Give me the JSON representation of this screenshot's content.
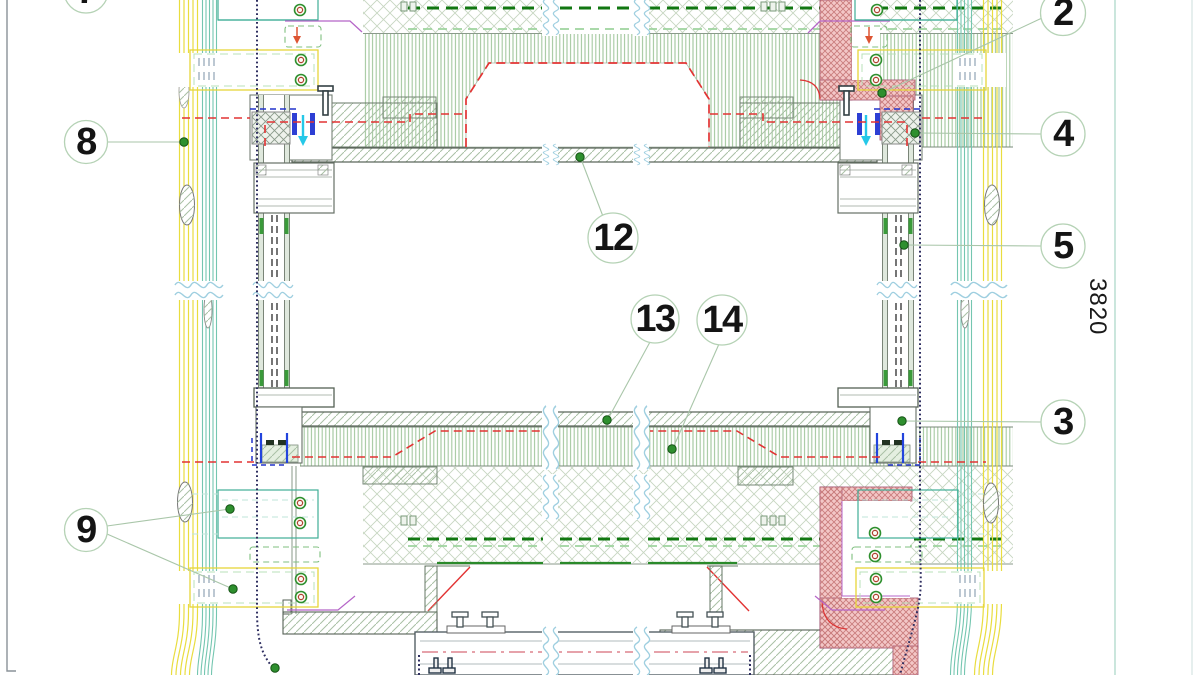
{
  "callouts": [
    {
      "id": "7",
      "label": "7"
    },
    {
      "id": "8",
      "label": "8"
    },
    {
      "id": "9",
      "label": "9"
    },
    {
      "id": "2",
      "label": "2"
    },
    {
      "id": "4",
      "label": "4"
    },
    {
      "id": "5",
      "label": "5"
    },
    {
      "id": "3",
      "label": "3"
    },
    {
      "id": "12",
      "label": "12"
    },
    {
      "id": "13",
      "label": "13"
    },
    {
      "id": "14",
      "label": "14"
    }
  ],
  "dimension": {
    "label": "3820"
  },
  "colors": {
    "band_yellow": "#e9dd3f",
    "band_teal": "#74c6b0",
    "callout_ring": "#b5d2b5",
    "leader_dot_green": "#2e8f2e",
    "seal_red": "#e23333",
    "seal_blue": "#2d3fd4",
    "membrane_navy": "#2e2e60",
    "firestop_pink": "#f3c7c7",
    "hatch_green": "#a9c0a5",
    "dimension_line_teal": "#a8d6c6"
  }
}
